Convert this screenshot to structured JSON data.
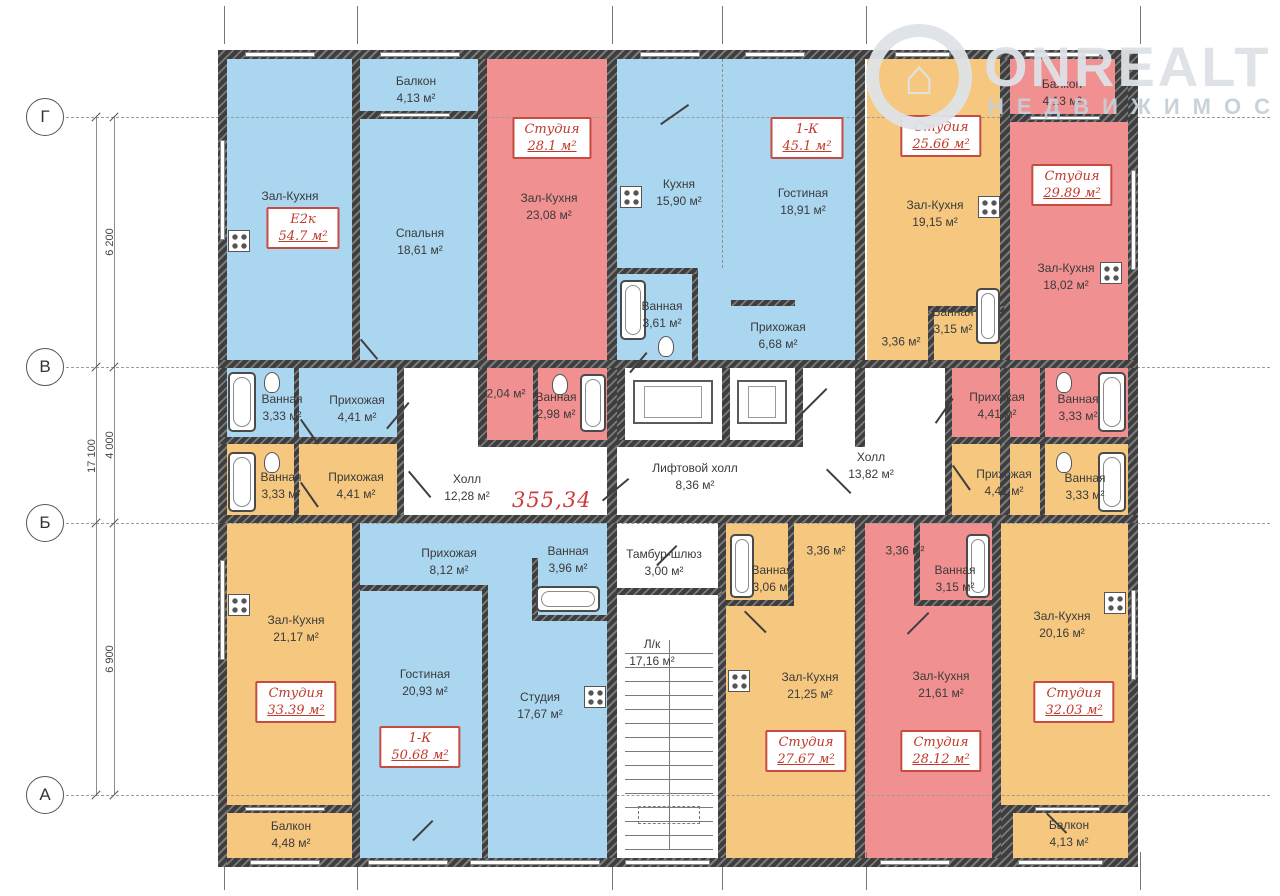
{
  "watermark": {
    "brand": "ONREALT",
    "subtitle": "НЕДВИЖИМОСТЬ",
    "logo": "house-pin-icon"
  },
  "total_area": {
    "value": "355,34",
    "x": 512,
    "y": 488
  },
  "palette": {
    "blue": "#abd6f0",
    "red": "#f19090",
    "orange": "#f6c87f",
    "wall": "#3e3e3e",
    "badge_red": "#c0392b"
  },
  "axes": {
    "rows": [
      {
        "label": "Г",
        "y": 117
      },
      {
        "label": "В",
        "y": 367
      },
      {
        "label": "Б",
        "y": 523
      },
      {
        "label": "А",
        "y": 795
      }
    ],
    "col_ticks_x": [
      224,
      357,
      612,
      722,
      866,
      1140
    ],
    "dim_lines_x": [
      96,
      114
    ],
    "dimensions": [
      {
        "label": "6 200",
        "x": 110,
        "y": 242
      },
      {
        "label": "4 000",
        "x": 110,
        "y": 445
      },
      {
        "label": "6 900",
        "x": 110,
        "y": 659
      },
      {
        "label": "17 100",
        "x": 92,
        "y": 456
      }
    ]
  },
  "plan": {
    "regions": [
      {
        "c": "blue",
        "x": 227,
        "y": 59,
        "w": 125,
        "h": 301
      },
      {
        "c": "blue",
        "x": 360,
        "y": 59,
        "w": 118,
        "h": 301
      },
      {
        "c": "blue",
        "x": 617,
        "y": 59,
        "w": 238,
        "h": 301
      },
      {
        "c": "blue",
        "x": 227,
        "y": 368,
        "w": 170,
        "h": 69
      },
      {
        "c": "blue",
        "x": 360,
        "y": 523,
        "w": 247,
        "h": 335
      },
      {
        "c": "red",
        "x": 487,
        "y": 59,
        "w": 120,
        "h": 301
      },
      {
        "c": "red",
        "x": 487,
        "y": 368,
        "w": 120,
        "h": 72
      },
      {
        "c": "red",
        "x": 1010,
        "y": 59,
        "w": 118,
        "h": 301
      },
      {
        "c": "red",
        "x": 952,
        "y": 368,
        "w": 176,
        "h": 69
      },
      {
        "c": "red",
        "x": 865,
        "y": 523,
        "w": 127,
        "h": 335
      },
      {
        "c": "orange",
        "x": 867,
        "y": 59,
        "w": 133,
        "h": 301
      },
      {
        "c": "orange",
        "x": 227,
        "y": 444,
        "w": 170,
        "h": 71
      },
      {
        "c": "orange",
        "x": 952,
        "y": 444,
        "w": 176,
        "h": 71
      },
      {
        "c": "orange",
        "x": 227,
        "y": 523,
        "w": 125,
        "h": 335
      },
      {
        "c": "orange",
        "x": 726,
        "y": 523,
        "w": 129,
        "h": 335
      },
      {
        "c": "orange",
        "x": 1001,
        "y": 523,
        "w": 127,
        "h": 335
      }
    ],
    "walls": [
      [
        218,
        50,
        920,
        9
      ],
      [
        218,
        858,
        920,
        9
      ],
      [
        218,
        50,
        9,
        817
      ],
      [
        1128,
        50,
        10,
        817
      ],
      [
        352,
        59,
        8,
        301
      ],
      [
        478,
        59,
        9,
        388
      ],
      [
        607,
        59,
        10,
        464
      ],
      [
        855,
        59,
        10,
        388
      ],
      [
        1000,
        59,
        10,
        464
      ],
      [
        360,
        111,
        118,
        8
      ],
      [
        1010,
        114,
        118,
        8
      ],
      [
        1115,
        59,
        13,
        63
      ],
      [
        218,
        360,
        920,
        8
      ],
      [
        218,
        437,
        186,
        7
      ],
      [
        480,
        440,
        130,
        7
      ],
      [
        617,
        440,
        186,
        7
      ],
      [
        952,
        437,
        176,
        7
      ],
      [
        218,
        515,
        920,
        8
      ],
      [
        397,
        368,
        7,
        147
      ],
      [
        294,
        368,
        5,
        69
      ],
      [
        294,
        444,
        5,
        71
      ],
      [
        533,
        368,
        5,
        72
      ],
      [
        945,
        368,
        7,
        147
      ],
      [
        1040,
        368,
        5,
        69
      ],
      [
        1040,
        444,
        5,
        71
      ],
      [
        617,
        368,
        8,
        72
      ],
      [
        722,
        368,
        8,
        72
      ],
      [
        795,
        368,
        8,
        72
      ],
      [
        352,
        523,
        8,
        335
      ],
      [
        607,
        523,
        10,
        335
      ],
      [
        718,
        523,
        8,
        335
      ],
      [
        855,
        523,
        10,
        335
      ],
      [
        992,
        523,
        9,
        335
      ],
      [
        482,
        590,
        6,
        268
      ],
      [
        360,
        585,
        128,
        6
      ],
      [
        532,
        558,
        6,
        62
      ],
      [
        532,
        615,
        80,
        6
      ],
      [
        788,
        523,
        6,
        80
      ],
      [
        726,
        600,
        68,
        6
      ],
      [
        914,
        523,
        6,
        80
      ],
      [
        914,
        600,
        78,
        6
      ],
      [
        617,
        588,
        105,
        7
      ],
      [
        227,
        805,
        125,
        8
      ],
      [
        1001,
        805,
        127,
        8
      ],
      [
        1001,
        805,
        12,
        53
      ],
      [
        692,
        268,
        6,
        96
      ],
      [
        617,
        268,
        80,
        6
      ],
      [
        731,
        300,
        64,
        6
      ],
      [
        928,
        308,
        6,
        54
      ],
      [
        928,
        306,
        76,
        6
      ]
    ],
    "windows": [
      [
        245,
        52,
        70,
        5
      ],
      [
        380,
        52,
        80,
        5
      ],
      [
        640,
        52,
        60,
        5
      ],
      [
        745,
        52,
        60,
        5
      ],
      [
        895,
        52,
        55,
        5
      ],
      [
        1025,
        52,
        75,
        5
      ],
      [
        250,
        860,
        70,
        5
      ],
      [
        368,
        860,
        80,
        5
      ],
      [
        470,
        860,
        130,
        5
      ],
      [
        625,
        860,
        85,
        5
      ],
      [
        880,
        860,
        70,
        5
      ],
      [
        1018,
        860,
        85,
        5
      ],
      [
        220,
        140,
        5,
        100
      ],
      [
        220,
        560,
        5,
        100
      ],
      [
        1131,
        170,
        5,
        100
      ],
      [
        1131,
        590,
        5,
        90
      ],
      [
        380,
        113,
        70,
        4
      ],
      [
        1030,
        116,
        70,
        4
      ],
      [
        245,
        807,
        80,
        4
      ],
      [
        1035,
        807,
        65,
        4
      ]
    ],
    "labels": [
      {
        "name": "Зал-Кухня",
        "area": "24,22 м²",
        "x": 290,
        "y": 205
      },
      {
        "name": "Балкон",
        "area": "4,13 м²",
        "x": 416,
        "y": 90
      },
      {
        "name": "Спальня",
        "area": "18,61 м²",
        "x": 420,
        "y": 242
      },
      {
        "name": "Зал-Кухня",
        "area": "23,08 м²",
        "x": 549,
        "y": 207
      },
      {
        "name": "Кухня",
        "area": "15,90 м²",
        "x": 679,
        "y": 193
      },
      {
        "name": "Гостиная",
        "area": "18,91 м²",
        "x": 803,
        "y": 202
      },
      {
        "name": "Ванная",
        "area": "3,61 м²",
        "x": 662,
        "y": 315
      },
      {
        "name": "Прихожая",
        "area": "6,68 м²",
        "x": 778,
        "y": 336
      },
      {
        "name": "Зал-Кухня",
        "area": "19,15 м²",
        "x": 935,
        "y": 214
      },
      {
        "name": "",
        "area": "3,36 м²",
        "x": 901,
        "y": 342
      },
      {
        "name": "Ванная",
        "area": "3,15 м²",
        "x": 953,
        "y": 321
      },
      {
        "name": "Балкон",
        "area": "4,13 м²",
        "x": 1062,
        "y": 93
      },
      {
        "name": "Зал-Кухня",
        "area": "18,02 м²",
        "x": 1066,
        "y": 277
      },
      {
        "name": "Ванная",
        "area": "3,33 м²",
        "x": 282,
        "y": 408
      },
      {
        "name": "Прихожая",
        "area": "4,41 м²",
        "x": 357,
        "y": 409
      },
      {
        "name": "",
        "area": "2,04 м²",
        "x": 506,
        "y": 394
      },
      {
        "name": "Ванная",
        "area": "2,98 м²",
        "x": 556,
        "y": 406
      },
      {
        "name": "Холл",
        "area": "12,28 м²",
        "x": 467,
        "y": 488
      },
      {
        "name": "Лифтовой холл",
        "area": "8,36 м²",
        "x": 695,
        "y": 477
      },
      {
        "name": "Холл",
        "area": "13,82 м²",
        "x": 871,
        "y": 466
      },
      {
        "name": "Прихожая",
        "area": "4,41 м²",
        "x": 997,
        "y": 406
      },
      {
        "name": "Ванная",
        "area": "3,33 м²",
        "x": 1078,
        "y": 408
      },
      {
        "name": "Ванная",
        "area": "3,33 м²",
        "x": 281,
        "y": 486
      },
      {
        "name": "Прихожая",
        "area": "4,41 м²",
        "x": 356,
        "y": 486
      },
      {
        "name": "Прихожая",
        "area": "4,41 м²",
        "x": 1004,
        "y": 483
      },
      {
        "name": "Ванная",
        "area": "3,33 м²",
        "x": 1085,
        "y": 487
      },
      {
        "name": "Тамбур-шлюз",
        "area": "3,00 м²",
        "x": 664,
        "y": 563
      },
      {
        "name": "Л/к",
        "area": "17,16 м²",
        "x": 652,
        "y": 653
      },
      {
        "name": "Зал-Кухня",
        "area": "21,17 м²",
        "x": 296,
        "y": 629
      },
      {
        "name": "Балкон",
        "area": "4,48 м²",
        "x": 291,
        "y": 835
      },
      {
        "name": "Прихожая",
        "area": "8,12 м²",
        "x": 449,
        "y": 562
      },
      {
        "name": "Ванная",
        "area": "3,96 м²",
        "x": 568,
        "y": 560
      },
      {
        "name": "Гостиная",
        "area": "20,93 м²",
        "x": 425,
        "y": 683
      },
      {
        "name": "Студия",
        "area": "17,67 м²",
        "x": 540,
        "y": 706
      },
      {
        "name": "Ванная",
        "area": "3,06 м²",
        "x": 772,
        "y": 579
      },
      {
        "name": "",
        "area": "3,36 м²",
        "x": 826,
        "y": 551
      },
      {
        "name": "Зал-Кухня",
        "area": "21,25 м²",
        "x": 810,
        "y": 686
      },
      {
        "name": "",
        "area": "3,36 м²",
        "x": 905,
        "y": 551
      },
      {
        "name": "Ванная",
        "area": "3,15 м²",
        "x": 955,
        "y": 579
      },
      {
        "name": "Зал-Кухня",
        "area": "21,61 м²",
        "x": 941,
        "y": 685
      },
      {
        "name": "Зал-Кухня",
        "area": "20,16 м²",
        "x": 1062,
        "y": 625
      },
      {
        "name": "Балкон",
        "area": "4,13 м²",
        "x": 1069,
        "y": 834
      }
    ],
    "badges": [
      {
        "type": "Е2к",
        "area": "54.7 м²",
        "x": 303,
        "y": 228
      },
      {
        "type": "Студия",
        "area": "28.1 м²",
        "x": 552,
        "y": 138
      },
      {
        "type": "1-К",
        "area": "45.1 м²",
        "x": 807,
        "y": 138
      },
      {
        "type": "Студия",
        "area": "25.66 м²",
        "x": 941,
        "y": 136
      },
      {
        "type": "Студия",
        "area": "29.89 м²",
        "x": 1072,
        "y": 185
      },
      {
        "type": "Студия",
        "area": "33.39 м²",
        "x": 296,
        "y": 702
      },
      {
        "type": "1-К",
        "area": "50.68 м²",
        "x": 420,
        "y": 747
      },
      {
        "type": "Студия",
        "area": "27.67 м²",
        "x": 806,
        "y": 751
      },
      {
        "type": "Студия",
        "area": "28.12 м²",
        "x": 941,
        "y": 751
      },
      {
        "type": "Студия",
        "area": "32.03 м²",
        "x": 1074,
        "y": 702
      }
    ],
    "fixtures": {
      "tubs": [
        [
          228,
          372,
          28,
          60
        ],
        [
          228,
          452,
          28,
          60
        ],
        [
          1098,
          372,
          28,
          60
        ],
        [
          1098,
          452,
          28,
          60
        ],
        [
          620,
          280,
          26,
          60
        ],
        [
          976,
          288,
          24,
          56
        ],
        [
          580,
          374,
          26,
          58
        ],
        [
          730,
          534,
          24,
          64
        ],
        [
          966,
          534,
          24,
          64
        ],
        [
          536,
          586,
          64,
          26
        ]
      ],
      "stoves": [
        [
          228,
          230
        ],
        [
          620,
          186
        ],
        [
          978,
          196
        ],
        [
          1100,
          262
        ],
        [
          228,
          594
        ],
        [
          584,
          686
        ],
        [
          728,
          670
        ],
        [
          1104,
          592
        ]
      ],
      "toilets": [
        [
          264,
          372
        ],
        [
          264,
          452
        ],
        [
          1056,
          372
        ],
        [
          1056,
          452
        ],
        [
          658,
          336
        ],
        [
          552,
          374
        ]
      ],
      "elevator_cars": [
        [
          633,
          380,
          80,
          44
        ],
        [
          737,
          380,
          50,
          44
        ]
      ],
      "stairs": {
        "x": 625,
        "y": 640,
        "w": 88,
        "h": 210
      }
    },
    "doors": [
      [
        300,
        420,
        30,
        -35
      ],
      [
        300,
        483,
        30,
        -35
      ],
      [
        408,
        402,
        34,
        40
      ],
      [
        408,
        472,
        34,
        -40
      ],
      [
        628,
        478,
        34,
        50
      ],
      [
        826,
        388,
        34,
        45
      ],
      [
        826,
        470,
        34,
        -45
      ],
      [
        952,
        398,
        30,
        35
      ],
      [
        952,
        466,
        30,
        -35
      ],
      [
        676,
        545,
        28,
        45
      ],
      [
        744,
        612,
        30,
        -45
      ],
      [
        928,
        612,
        30,
        45
      ],
      [
        688,
        104,
        34,
        55
      ],
      [
        432,
        820,
        28,
        45
      ],
      [
        1046,
        814,
        28,
        -45
      ],
      [
        646,
        352,
        26,
        40
      ],
      [
        360,
        340,
        26,
        -40
      ]
    ],
    "dash_lines_v": [
      {
        "x": 722,
        "y": 59,
        "h": 209
      }
    ],
    "dash_rects": [
      {
        "x": 638,
        "y": 806,
        "w": 60,
        "h": 16
      }
    ]
  }
}
